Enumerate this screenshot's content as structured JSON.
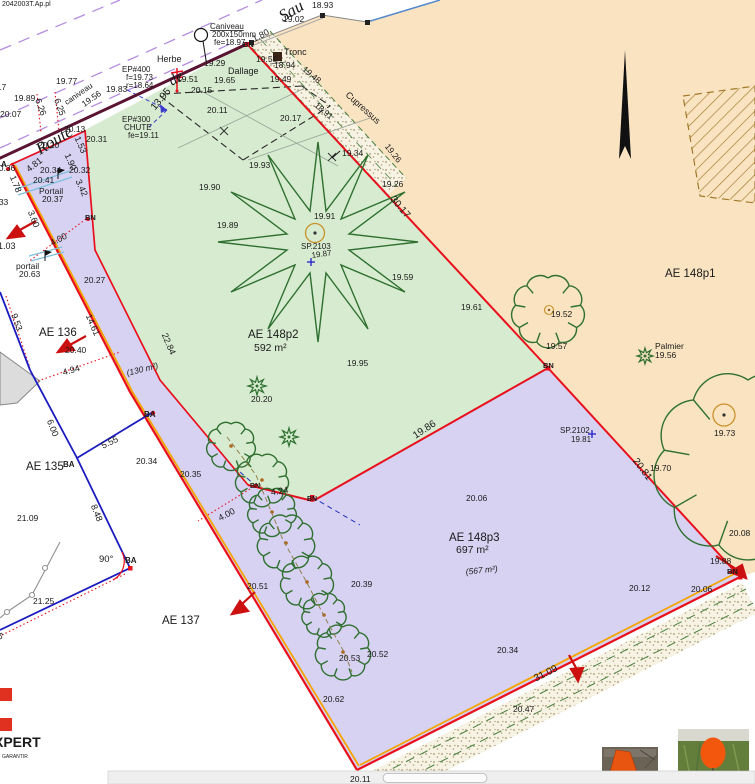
{
  "colors": {
    "parcel_tan": "#f9e3c1",
    "parcel_green": "#d7ebd0",
    "parcel_lavender": "#d7d2f2",
    "boundary_red": "#e8101c",
    "edge_orange": "#f5a400",
    "wall_maroon": "#5a1432",
    "cadastre_blue": "#1b1bc0",
    "label_blue": "#1f1fc8",
    "tree_green": "#2f7030",
    "road_dash_violet": "#b48ce0",
    "logo_red": "#e03020"
  },
  "parcels": [
    {
      "id": "AE 148p1"
    },
    {
      "id": "AE 148p2",
      "area": "592 m²"
    },
    {
      "id": "AE 148p3",
      "area": "697 m²",
      "secondary_area": "(567 m²)"
    },
    {
      "id": "AE 135"
    },
    {
      "id": "AE 136"
    },
    {
      "id": "AE 137"
    }
  ],
  "logo": {
    "text": "XPERT",
    "tagline": "GARANTIR"
  },
  "texts": [
    {
      "t": "2042003T.Ap.pl",
      "x": 2,
      "y": 6,
      "s": 7,
      "c": "gy",
      "n": "top-edge-fragment"
    },
    {
      "t": "Route",
      "x": 40,
      "y": 155,
      "s": 17,
      "r": -31,
      "f": "ser",
      "fs": 1,
      "n": "street-name"
    },
    {
      "t": "de",
      "x": 172,
      "y": 86,
      "s": 15,
      "r": -31,
      "f": "ser",
      "fs": 1,
      "n": "street-name"
    },
    {
      "t": "Sau",
      "x": 283,
      "y": 22,
      "s": 17,
      "r": -31,
      "f": "ser",
      "fs": 1,
      "n": "street-name"
    },
    {
      "t": "19.83",
      "x": 106,
      "y": 92
    },
    {
      "t": "19.77",
      "x": 56,
      "y": 84
    },
    {
      "t": "19.89",
      "x": 14,
      "y": 101
    },
    {
      "t": "20.07",
      "x": 0,
      "y": 117
    },
    {
      "t": "20.17",
      "x": -15,
      "y": 90
    },
    {
      "t": "6.26",
      "x": 38,
      "y": 108,
      "c": "r",
      "r": 70,
      "a": "m",
      "s": 9
    },
    {
      "t": "6.25",
      "x": 57,
      "y": 108,
      "c": "r",
      "r": 70,
      "a": "m",
      "s": 9
    },
    {
      "t": "caniveau",
      "x": 80,
      "y": 96,
      "c": "b",
      "r": -35,
      "a": "m",
      "s": 8
    },
    {
      "t": "19.56",
      "x": 93,
      "y": 101,
      "r": -35,
      "a": "m"
    },
    {
      "t": "EP#400",
      "x": 122,
      "y": 72,
      "c": "b",
      "s": 8
    },
    {
      "t": "f=19.73",
      "x": 126,
      "y": 80,
      "c": "b",
      "s": 8
    },
    {
      "t": "r=18.64",
      "x": 126,
      "y": 88,
      "c": "b",
      "s": 8
    },
    {
      "t": "Caniveau",
      "x": 210,
      "y": 29,
      "c": "b",
      "s": 8,
      "u": 1
    },
    {
      "t": "200x150mm",
      "x": 212,
      "y": 37,
      "c": "b",
      "s": 8
    },
    {
      "t": "fe=18.97",
      "x": 214,
      "y": 45,
      "c": "b",
      "s": 8
    },
    {
      "t": "Herbe",
      "x": 157,
      "y": 62,
      "s": 9
    },
    {
      "t": "19.29",
      "x": 204,
      "y": 66
    },
    {
      "t": "BN",
      "x": 243,
      "y": 47,
      "c": "r",
      "s": 7.5,
      "fw": 1
    },
    {
      "t": "1.80",
      "x": 262,
      "y": 38,
      "c": "b",
      "r": -27,
      "a": "m",
      "s": 9
    },
    {
      "t": "Tronc",
      "x": 284,
      "y": 55,
      "s": 9
    },
    {
      "t": "19.02",
      "x": 283,
      "y": 22
    },
    {
      "t": "18.93",
      "x": 312,
      "y": 8
    },
    {
      "t": "19.55",
      "x": 256,
      "y": 62
    },
    {
      "t": "18.94",
      "x": 274,
      "y": 68
    },
    {
      "t": "19.49",
      "x": 270,
      "y": 82
    },
    {
      "t": "19.48",
      "x": 310,
      "y": 77,
      "r": 40,
      "a": "m"
    },
    {
      "t": "Cupressus",
      "x": 361,
      "y": 110,
      "c": "g",
      "r": 42,
      "a": "m",
      "s": 9
    },
    {
      "t": "18.91",
      "x": 322,
      "y": 113,
      "r": 40,
      "a": "m"
    },
    {
      "t": "20.17",
      "x": 280,
      "y": 121
    },
    {
      "t": "19.34",
      "x": 342,
      "y": 156
    },
    {
      "t": "19.26",
      "x": 391,
      "y": 155,
      "r": 52,
      "a": "m"
    },
    {
      "t": "19.26",
      "x": 382,
      "y": 187
    },
    {
      "t": "19.51",
      "x": 177,
      "y": 82
    },
    {
      "t": "Dallage",
      "x": 228,
      "y": 74,
      "s": 9
    },
    {
      "t": "19.65",
      "x": 214,
      "y": 83
    },
    {
      "t": "20.15",
      "x": 191,
      "y": 93
    },
    {
      "t": "20.11",
      "x": 207,
      "y": 113
    },
    {
      "t": "EP#300",
      "x": 122,
      "y": 122,
      "c": "b",
      "s": 8
    },
    {
      "t": "CHUTE",
      "x": 124,
      "y": 130,
      "c": "b",
      "s": 8
    },
    {
      "t": "fe=19.11",
      "x": 128,
      "y": 138,
      "c": "b",
      "s": 8
    },
    {
      "t": "20.13",
      "x": 64,
      "y": 132
    },
    {
      "t": "20.31",
      "x": 86,
      "y": 142
    },
    {
      "t": "13.95",
      "x": 163,
      "y": 101,
      "c": "r",
      "r": -50,
      "a": "m",
      "s": 10
    },
    {
      "t": "20.20",
      "x": 38,
      "y": 148
    },
    {
      "t": "20.36",
      "x": -6,
      "y": 171
    },
    {
      "t": "4.81",
      "x": 36,
      "y": 167,
      "c": "r",
      "r": -38,
      "a": "m",
      "s": 9
    },
    {
      "t": "20.34",
      "x": 40,
      "y": 173
    },
    {
      "t": "20.41",
      "x": 33,
      "y": 183
    },
    {
      "t": "20.32",
      "x": 69,
      "y": 173
    },
    {
      "t": "1.53",
      "x": 78,
      "y": 146,
      "c": "r",
      "r": 66,
      "a": "m",
      "s": 9
    },
    {
      "t": "1.90",
      "x": 68,
      "y": 163,
      "c": "r",
      "r": 66,
      "a": "m",
      "s": 9
    },
    {
      "t": "3.42",
      "x": 79,
      "y": 189,
      "c": "r",
      "r": 66,
      "a": "m",
      "s": 9
    },
    {
      "t": "Portail",
      "x": 39,
      "y": 194,
      "s": 8.5
    },
    {
      "t": "20.37",
      "x": 42,
      "y": 202
    },
    {
      "t": "1.78",
      "x": 13,
      "y": 185,
      "c": "r",
      "r": 68,
      "a": "m",
      "s": 9
    },
    {
      "t": "A",
      "x": 1,
      "y": 167,
      "c": "b",
      "s": 8,
      "fw": 1
    },
    {
      "t": "20.33",
      "x": -13,
      "y": 205
    },
    {
      "t": "3.60",
      "x": 31,
      "y": 220,
      "c": "r",
      "r": 68,
      "a": "m",
      "s": 9
    },
    {
      "t": "BN",
      "x": 85,
      "y": 220,
      "c": "r",
      "s": 7.5,
      "fw": 1
    },
    {
      "t": "4.00",
      "x": 60,
      "y": 242,
      "c": "r",
      "r": -28,
      "a": "m",
      "s": 9
    },
    {
      "t": "1.03",
      "x": -2,
      "y": 249,
      "c": "r",
      "s": 9
    },
    {
      "t": "portail",
      "x": 16,
      "y": 269,
      "s": 8.5
    },
    {
      "t": "20.63",
      "x": 19,
      "y": 277
    },
    {
      "t": "20.27",
      "x": 84,
      "y": 283
    },
    {
      "t": "9.53",
      "x": 14,
      "y": 323,
      "c": "r",
      "r": 70,
      "a": "m",
      "s": 9
    },
    {
      "t": "AE 136",
      "x": 39,
      "y": 336,
      "s": 11.5,
      "n": "parcel-label-ae136"
    },
    {
      "t": "20.40",
      "x": 65,
      "y": 353
    },
    {
      "t": "14.61",
      "x": 90,
      "y": 326,
      "c": "r",
      "r": 67,
      "a": "m",
      "s": 9
    },
    {
      "t": "22.84",
      "x": 166,
      "y": 345,
      "c": "r",
      "r": 67,
      "a": "m",
      "s": 9
    },
    {
      "t": "(130 m²)",
      "x": 143,
      "y": 372,
      "c": "b",
      "r": -14,
      "a": "m",
      "s": 8.5,
      "fs": 1
    },
    {
      "t": "4.94",
      "x": 72,
      "y": 373,
      "c": "r",
      "r": -16,
      "a": "m",
      "s": 9
    },
    {
      "t": "BA",
      "x": 144,
      "y": 417,
      "c": "b",
      "s": 8,
      "fw": 1
    },
    {
      "t": "20.34",
      "x": 136,
      "y": 464
    },
    {
      "t": "20.35",
      "x": 180,
      "y": 477
    },
    {
      "t": "6.00",
      "x": 50,
      "y": 429,
      "c": "r",
      "r": 68,
      "a": "m",
      "s": 9
    },
    {
      "t": "5.55",
      "x": 111,
      "y": 445,
      "c": "r",
      "r": -26,
      "a": "m",
      "s": 9
    },
    {
      "t": "BA",
      "x": 63,
      "y": 467,
      "c": "b",
      "s": 8,
      "fw": 1
    },
    {
      "t": "AE 135",
      "x": 26,
      "y": 470,
      "s": 11.5,
      "n": "parcel-label-ae135"
    },
    {
      "t": "21.09",
      "x": 17,
      "y": 521
    },
    {
      "t": "8.48",
      "x": 94,
      "y": 514,
      "c": "r",
      "r": 68,
      "a": "m",
      "s": 9
    },
    {
      "t": "90°",
      "x": 99,
      "y": 562,
      "c": "r",
      "s": 9.5
    },
    {
      "t": "BA",
      "x": 125,
      "y": 563,
      "c": "b",
      "s": 8,
      "fw": 1
    },
    {
      "t": "21.25",
      "x": 33,
      "y": 604
    },
    {
      "t": "11.75",
      "x": -8,
      "y": 634,
      "c": "r",
      "r": 34,
      "a": "m",
      "s": 9
    },
    {
      "t": "AE 137",
      "x": 162,
      "y": 624,
      "s": 11.5,
      "n": "parcel-label-ae137"
    },
    {
      "t": "20.51",
      "x": 247,
      "y": 589
    },
    {
      "t": "20.39",
      "x": 351,
      "y": 587
    },
    {
      "t": "20.53",
      "x": 339,
      "y": 661
    },
    {
      "t": "20.52",
      "x": 367,
      "y": 657
    },
    {
      "t": "20.62",
      "x": 323,
      "y": 702
    },
    {
      "t": "20.34",
      "x": 497,
      "y": 653
    },
    {
      "t": "(567 m²)",
      "x": 482,
      "y": 573,
      "c": "b",
      "r": -6,
      "a": "m",
      "s": 8.5,
      "fs": 1
    },
    {
      "t": "AE 148p3",
      "x": 449,
      "y": 541,
      "s": 11.5,
      "n": "parcel-label-ae148p3"
    },
    {
      "t": "697 m²",
      "x": 456,
      "y": 553,
      "c": "r",
      "s": 10.5,
      "n": "parcel-area-ae148p3"
    },
    {
      "t": "20.06",
      "x": 466,
      "y": 501
    },
    {
      "t": "AE 148p2",
      "x": 248,
      "y": 338,
      "s": 11.5,
      "n": "parcel-label-ae148p2"
    },
    {
      "t": "592 m²",
      "x": 254,
      "y": 351,
      "c": "r",
      "s": 10.5,
      "n": "parcel-area-ae148p2"
    },
    {
      "t": "19.95",
      "x": 347,
      "y": 366
    },
    {
      "t": "19.89",
      "x": 217,
      "y": 228
    },
    {
      "t": "19.91",
      "x": 314,
      "y": 219
    },
    {
      "t": "SP.2103",
      "x": 301,
      "y": 249,
      "c": "b",
      "s": 8
    },
    {
      "t": "19.87",
      "x": 312,
      "y": 258,
      "c": "b",
      "s": 8,
      "r": -8
    },
    {
      "t": "19.59",
      "x": 392,
      "y": 280
    },
    {
      "t": "30.17",
      "x": 398,
      "y": 209,
      "c": "r",
      "r": 50,
      "a": "m",
      "s": 10
    },
    {
      "t": "19.61",
      "x": 461,
      "y": 310
    },
    {
      "t": "19.52",
      "x": 551,
      "y": 317
    },
    {
      "t": "19.57",
      "x": 546,
      "y": 349
    },
    {
      "t": "BN",
      "x": 543,
      "y": 368,
      "c": "r",
      "s": 7.5,
      "fw": 1
    },
    {
      "t": "AE 148p1",
      "x": 665,
      "y": 277,
      "s": 11.5,
      "n": "parcel-label-ae148p1"
    },
    {
      "t": "Palmier",
      "x": 655,
      "y": 349,
      "s": 8.5
    },
    {
      "t": "19.56",
      "x": 655,
      "y": 358
    },
    {
      "t": "SP.2102",
      "x": 560,
      "y": 433,
      "c": "b",
      "s": 8
    },
    {
      "t": "19.81",
      "x": 571,
      "y": 442,
      "c": "b",
      "s": 8
    },
    {
      "t": "20.81",
      "x": 640,
      "y": 471,
      "c": "r",
      "r": 53,
      "a": "m",
      "s": 10
    },
    {
      "t": "19.70",
      "x": 650,
      "y": 471
    },
    {
      "t": "19.73",
      "x": 714,
      "y": 436
    },
    {
      "t": "20.08",
      "x": 729,
      "y": 536
    },
    {
      "t": "19.88",
      "x": 710,
      "y": 564
    },
    {
      "t": "BN",
      "x": 727,
      "y": 574,
      "c": "r",
      "s": 7.5,
      "fw": 1
    },
    {
      "t": "20.12",
      "x": 629,
      "y": 591
    },
    {
      "t": "20.06",
      "x": 691,
      "y": 592
    },
    {
      "t": "31.09",
      "x": 547,
      "y": 676,
      "c": "r",
      "r": -27,
      "a": "m",
      "s": 10
    },
    {
      "t": "20.47",
      "x": 513,
      "y": 712
    },
    {
      "t": "20.11",
      "x": 350,
      "y": 782
    },
    {
      "t": "20.20",
      "x": 251,
      "y": 402
    },
    {
      "t": "4.24",
      "x": 280,
      "y": 494,
      "c": "r",
      "r": -9,
      "a": "m",
      "s": 9
    },
    {
      "t": "4.00",
      "x": 228,
      "y": 517,
      "c": "r",
      "r": -28,
      "a": "m",
      "s": 9
    },
    {
      "t": "BN",
      "x": 250,
      "y": 488,
      "c": "r",
      "s": 7,
      "fw": 1
    },
    {
      "t": "BN",
      "x": 307,
      "y": 501,
      "c": "r",
      "s": 7,
      "fw": 1
    },
    {
      "t": "19.86",
      "x": 426,
      "y": 432,
      "c": "r",
      "r": -33,
      "a": "m",
      "s": 10
    },
    {
      "t": "19.93",
      "x": 249,
      "y": 168
    },
    {
      "t": "19.90",
      "x": 199,
      "y": 190
    },
    {
      "t": "XPERT",
      "x": -6,
      "y": 747,
      "s": 14,
      "fw": 1,
      "n": "logo-text"
    },
    {
      "t": "GARANTIR",
      "x": 2,
      "y": 758,
      "s": 5,
      "c": "gy",
      "n": "logo-tagline"
    }
  ]
}
